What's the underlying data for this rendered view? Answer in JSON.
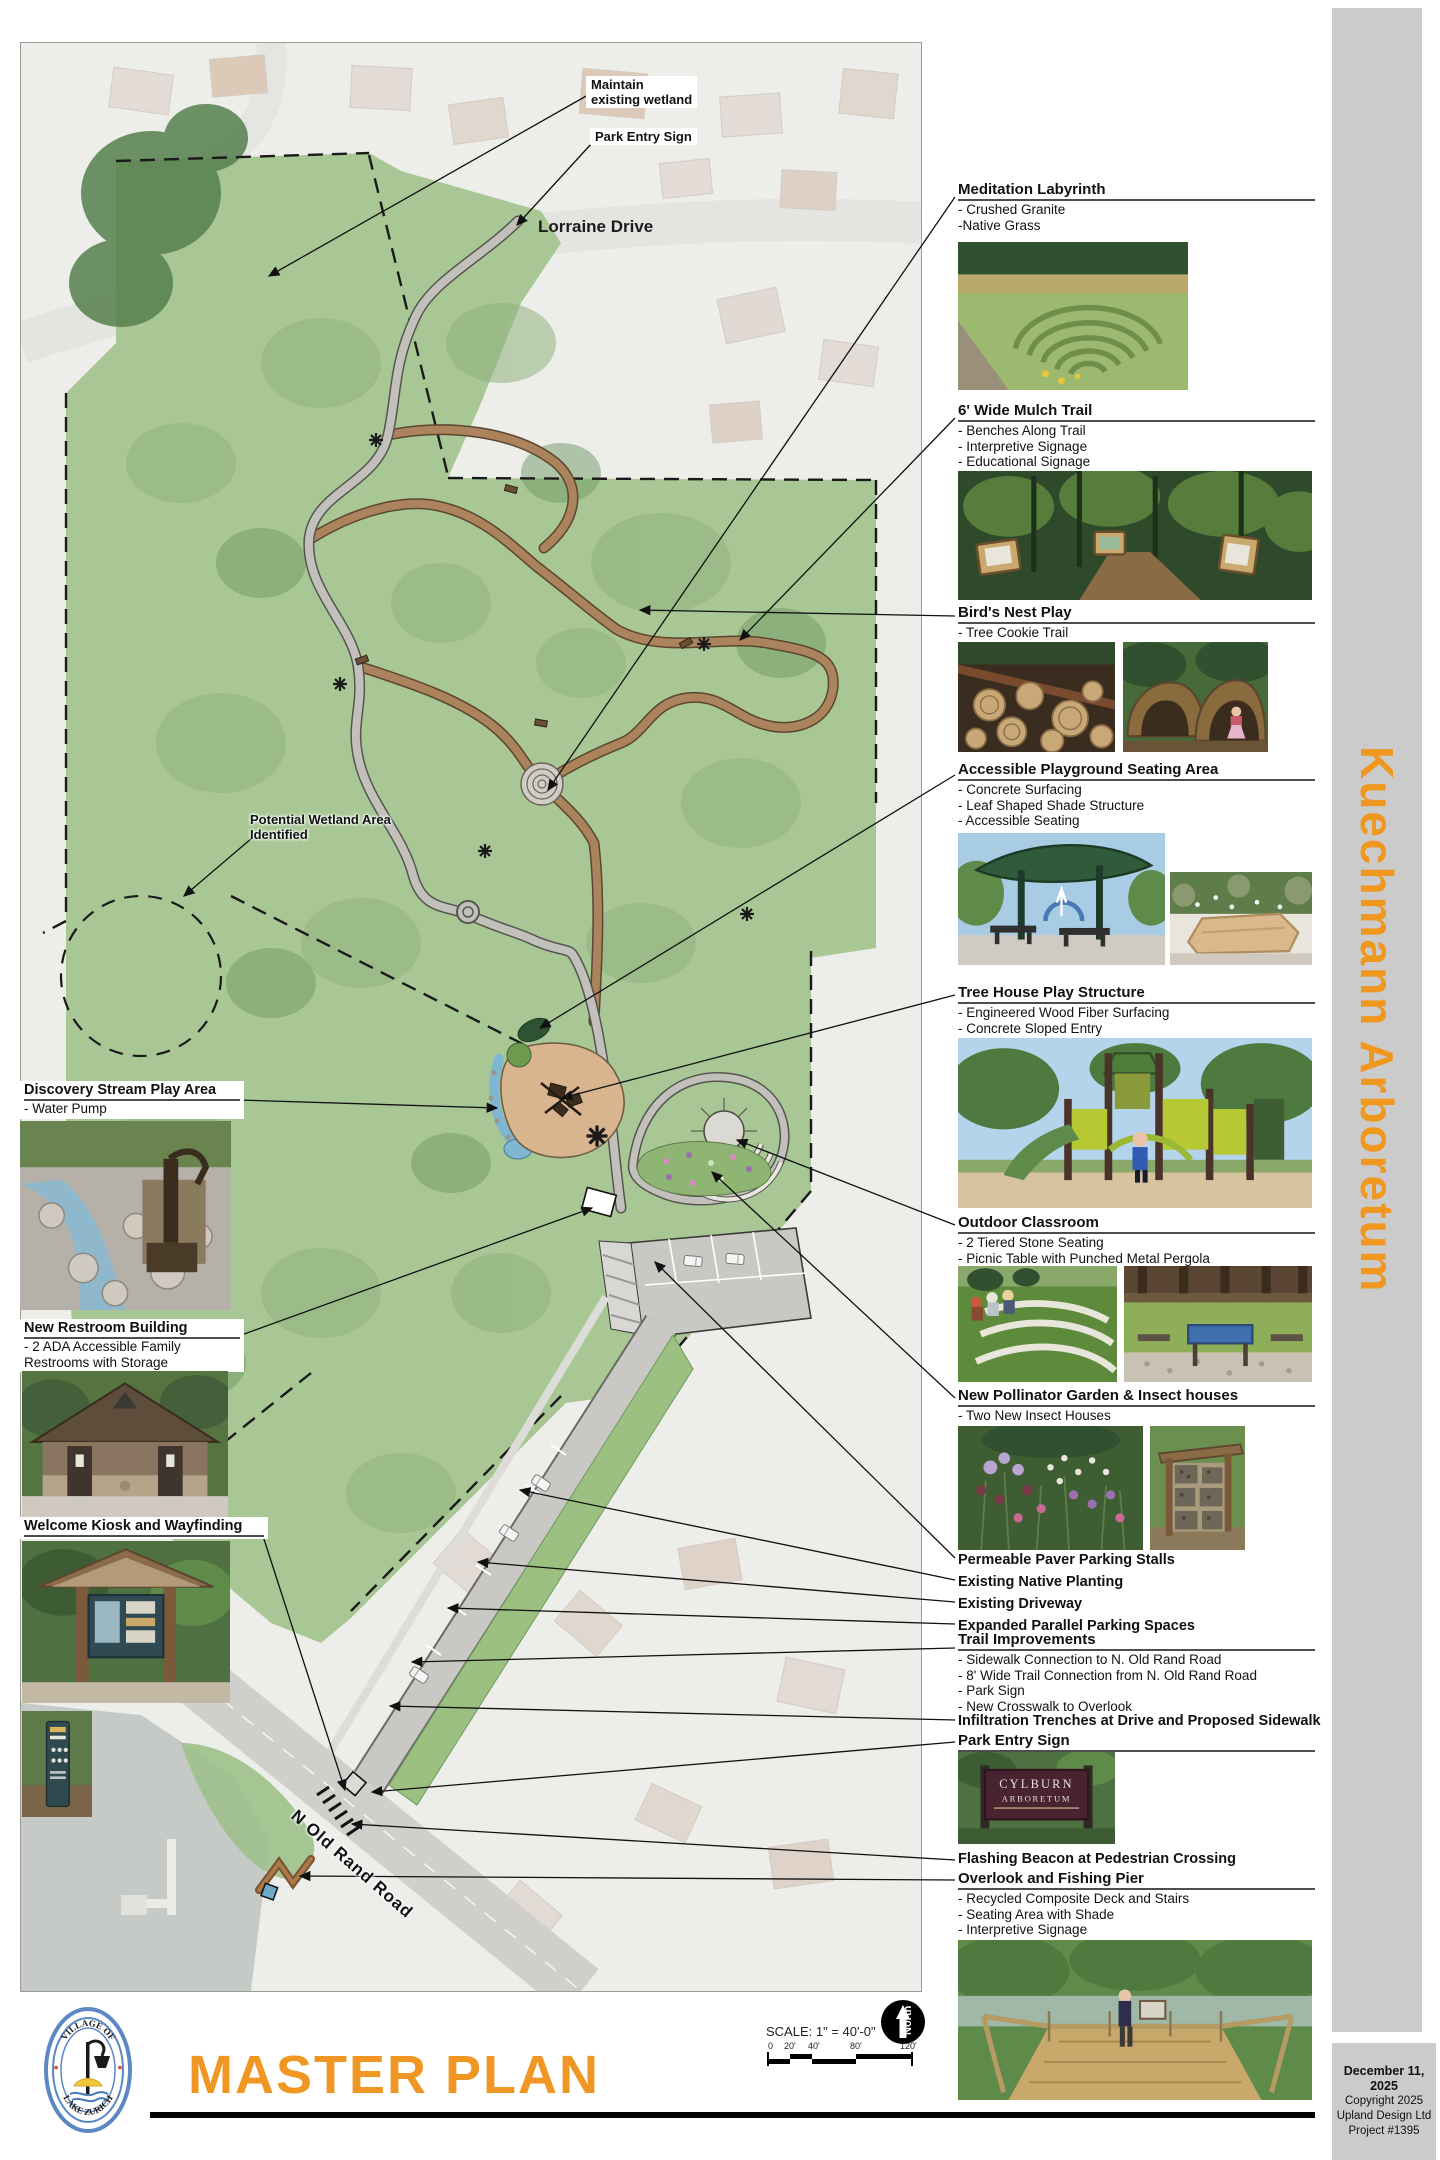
{
  "sidebar": {
    "title": "Kuechmann Arboretum",
    "accent_color": "#f0971f",
    "band_color": "#cbcbcb",
    "date": "December 11, 2025",
    "copyright": "Copyright 2025",
    "firm": "Upland Design Ltd",
    "project": "Project #1395"
  },
  "titleblock": {
    "title": "MASTER PLAN",
    "title_color": "#ef9722",
    "scale_label": "SCALE: 1\" = 40'-0\"",
    "scale_ticks": [
      "0",
      "20'",
      "40'",
      "80'",
      "120'"
    ],
    "north_label": "North",
    "logo_arc_top": "VILLAGE OF",
    "logo_arc_bottom": "LAKE ZURICH"
  },
  "map_labels": {
    "maintain_1": "Maintain",
    "maintain_2": "existing wetland",
    "park_entry_sign": "Park Entry Sign",
    "lorraine_drive": "Lorraine Drive",
    "wetland_1": "Potential Wetland Area",
    "wetland_2": "Identified",
    "road": "N Old Rand Road"
  },
  "left_column": {
    "sections": [
      {
        "title": "Discovery Stream Play Area",
        "bullets": [
          "- Water Pump"
        ]
      },
      {
        "title": "New Restroom Building",
        "bullets": [
          "- 2 ADA Accessible Family",
          "Restrooms with Storage"
        ]
      },
      {
        "title": "Welcome Kiosk and Wayfinding",
        "bullets": []
      }
    ]
  },
  "right_column": {
    "sections": [
      {
        "title": "Meditation Labyrinth",
        "bullets": [
          "- Crushed Granite",
          "-Native Grass"
        ]
      },
      {
        "title": "6' Wide Mulch Trail",
        "bullets": [
          "- Benches Along Trail",
          "- Interpretive Signage",
          "- Educational Signage"
        ]
      },
      {
        "title": "Bird's Nest Play",
        "bullets": [
          "- Tree Cookie Trail"
        ]
      },
      {
        "title": "Accessible Playground Seating Area",
        "bullets": [
          "- Concrete Surfacing",
          "- Leaf Shaped Shade Structure",
          "-  Accessible Seating"
        ]
      },
      {
        "title": "Tree House Play Structure",
        "bullets": [
          "- Engineered Wood Fiber Surfacing",
          "- Concrete Sloped Entry"
        ]
      },
      {
        "title": "Outdoor Classroom",
        "bullets": [
          "- 2 Tiered Stone Seating",
          "- Picnic Table with Punched Metal Pergola"
        ]
      },
      {
        "title": "New Pollinator Garden & Insect houses",
        "bullets": [
          "- Two New Insect Houses"
        ]
      }
    ],
    "flags": [
      "Permeable Paver Parking Stalls",
      "Existing Native Planting",
      "Existing Driveway",
      "Expanded Parallel Parking Spaces"
    ],
    "trail_improvements": {
      "title": "Trail Improvements",
      "bullets": [
        "- Sidewalk Connection to N. Old Rand Road",
        "- 8' Wide Trail Connection from N. Old Rand Road",
        "- Park Sign",
        "- New Crosswalk to Overlook"
      ]
    },
    "infiltration": "Infiltration Trenches at Drive and Proposed Sidewalk",
    "park_entry_sign_title": "Park Entry Sign",
    "flashing_beacon": "Flashing Beacon at Pedestrian Crossing",
    "overlook": {
      "title": "Overlook and Fishing Pier",
      "bullets": [
        "- Recycled Composite Deck and Stairs",
        "- Seating Area with Shade",
        "- Interpretive Signage"
      ]
    },
    "cylburn_sign": {
      "line1": "CYLBURN",
      "line2": "ARBORETUM"
    }
  }
}
